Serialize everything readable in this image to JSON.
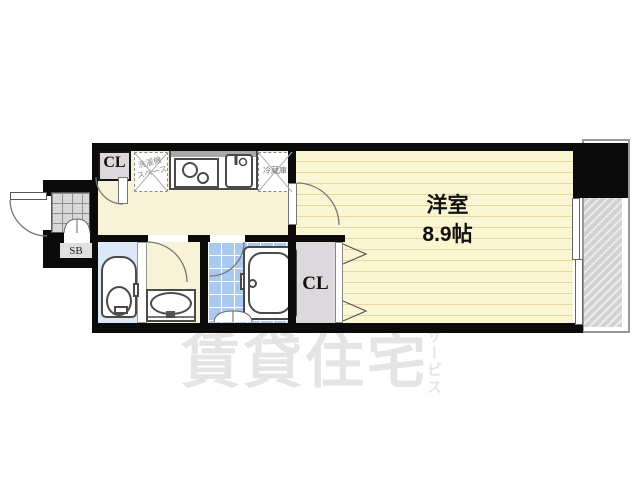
{
  "image_type": "japanese-apartment-floorplan",
  "watermark": {
    "text": "賃貸住宅",
    "vertical_text": "サービス",
    "color": "#e4e4e4"
  },
  "rooms": {
    "main_room": {
      "name": "洋室",
      "size": "8.9帖"
    },
    "closet_top": {
      "label": "CL"
    },
    "closet_bottom": {
      "label": "CL"
    },
    "shoe_box": {
      "label": "SB"
    },
    "washer_space": {
      "label_line1": "洗濯機",
      "label_line2": "スペース"
    },
    "refrigerator": {
      "label": "冷蔵庫"
    }
  },
  "fixtures": [
    "entrance-door",
    "genkan-tile",
    "shoe-box",
    "closet-top",
    "washing-machine-space",
    "gas-stove",
    "kitchen-sink",
    "refrigerator-space",
    "toilet",
    "washbasin",
    "bathtub",
    "bathroom",
    "closet-bottom",
    "sliding-window",
    "balcony"
  ],
  "colors": {
    "wall": "#0b0b0b",
    "kitchen_floor": "#f8f3d6",
    "room_floor": "#faf5d2",
    "room_floor_line": "#e9d79e",
    "toilet_floor": "#dde9f6",
    "bath_tile": "#a9c9ef",
    "genkan_tile": "#d8d8d8",
    "closet_fill": "#dcd8dc",
    "balcony_hatch": "#d2d2d2"
  }
}
